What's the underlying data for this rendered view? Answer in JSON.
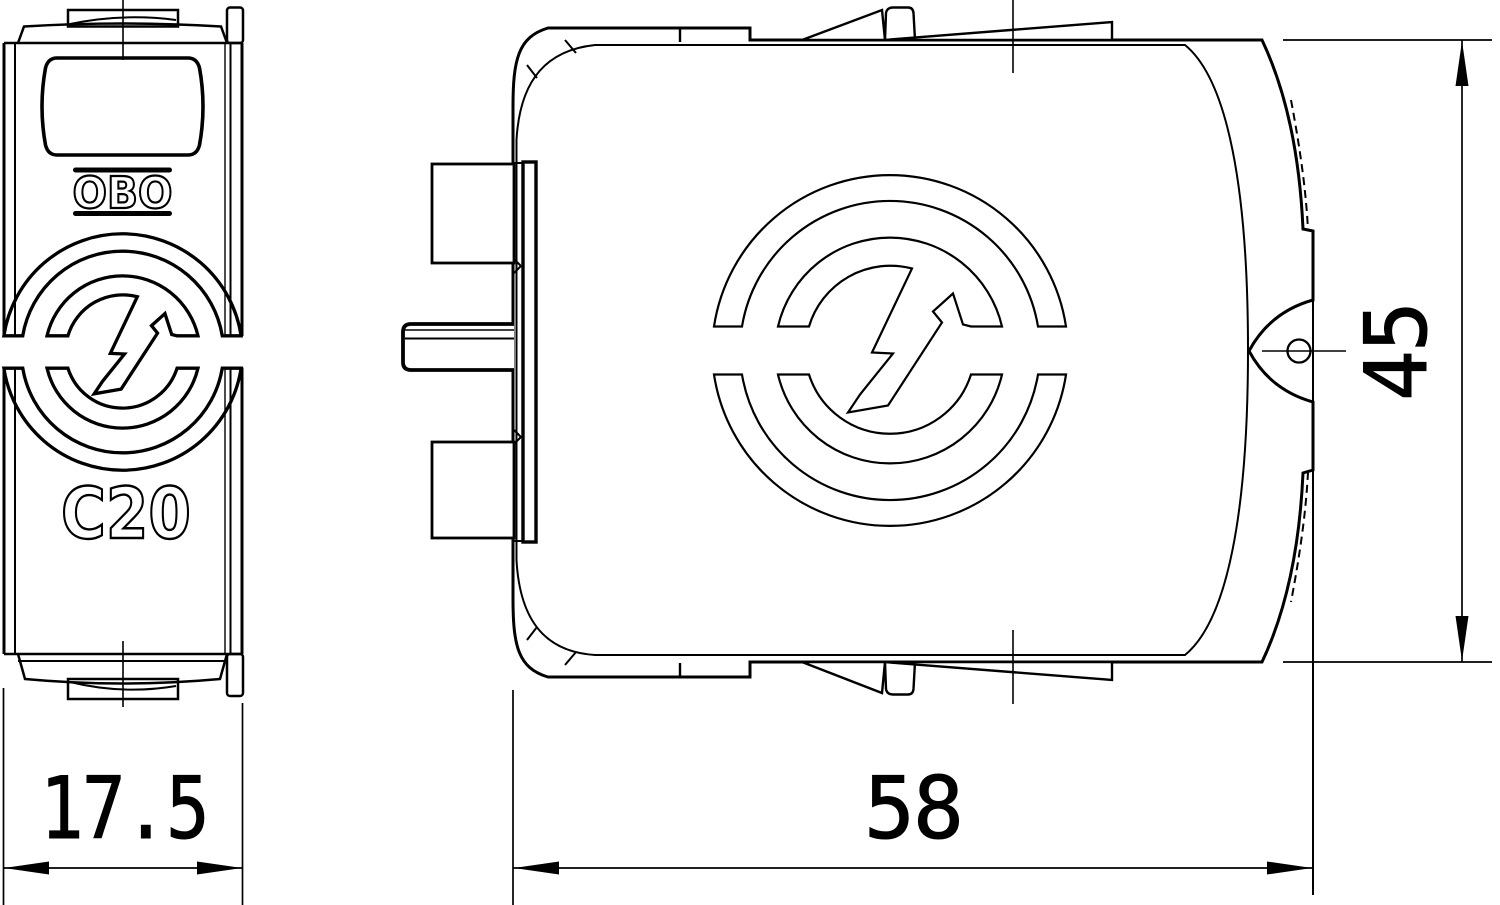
{
  "drawing": {
    "background": "#ffffff",
    "line_color": "#000000",
    "views": {
      "front": {
        "brand_label": "OBO",
        "type_label": "C20"
      },
      "side": {}
    },
    "dimensions": {
      "depth": {
        "value": "17.5"
      },
      "width": {
        "value": "58"
      },
      "height": {
        "value": "45"
      }
    },
    "icons": {
      "logo": "obo-lightning-surge-logo"
    }
  }
}
